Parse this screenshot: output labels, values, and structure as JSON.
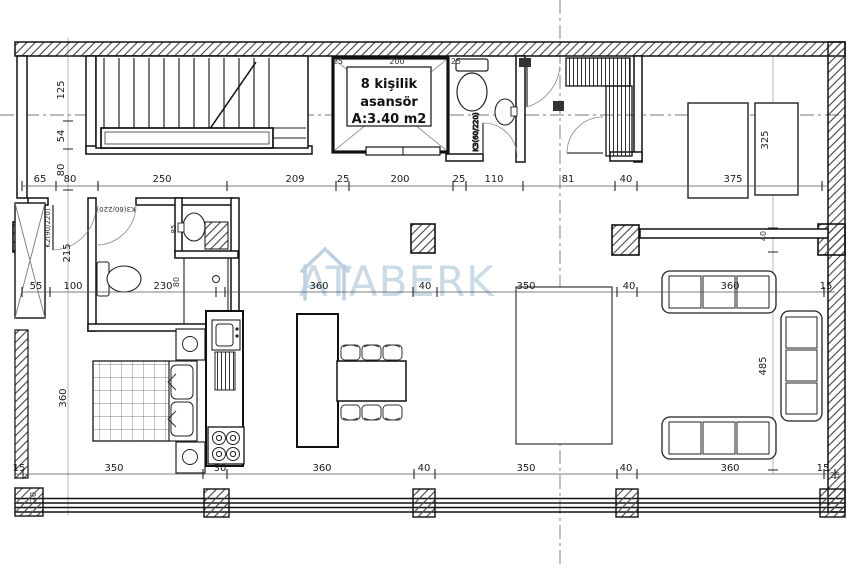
{
  "watermark": {
    "text": "ATABERK"
  },
  "elevator": {
    "l1": "8 kişilik",
    "l2": "asansör",
    "l3": "A:3.40 m2"
  },
  "doors": {
    "entry": "K2(90/220)",
    "bath": "K3(60/220)",
    "wc": "K3(60/220)"
  },
  "dims": {
    "upper": [
      "25",
      "200",
      "25"
    ],
    "top": [
      "65",
      "80",
      "250",
      "209",
      "25",
      "200",
      "25",
      "110",
      "81",
      "40",
      "375"
    ],
    "mid": [
      "55",
      "100",
      "230",
      "80",
      "360",
      "40",
      "350",
      "40",
      "360",
      "15"
    ],
    "bottom": [
      "15",
      "350",
      "30",
      "360",
      "40",
      "350",
      "40",
      "360",
      "15",
      "25"
    ],
    "left": [
      "125",
      "54",
      "80",
      "215",
      "360",
      "20"
    ],
    "right": [
      "325",
      "40",
      "485"
    ],
    "bath_sink": "85"
  }
}
